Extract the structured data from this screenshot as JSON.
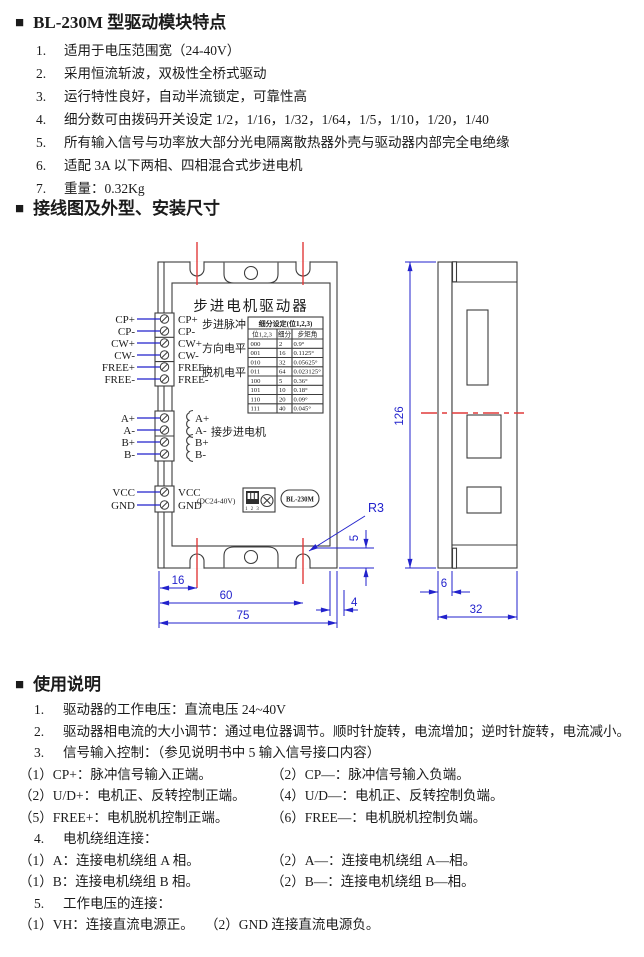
{
  "features": {
    "marker": "■",
    "title": "BL-230M 型驱动模块特点",
    "items": [
      {
        "num": "1.",
        "text": "适用于电压范围宽（24-40V）"
      },
      {
        "num": "2.",
        "text": "采用恒流斩波，双极性全桥式驱动"
      },
      {
        "num": "3.",
        "text": "运行特性良好，自动半流锁定，可靠性高"
      },
      {
        "num": "4.",
        "text": "细分数可由拨码开关设定 1/2，1/16，1/32，1/64，1/5，1/10，1/20，1/40"
      },
      {
        "num": "5.",
        "text": "所有输入信号与功率放大部分光电隔离散热器外壳与驱动器内部完全电绝缘"
      },
      {
        "num": "6.",
        "text": "适配 3A 以下两相、四相混合式步进电机"
      },
      {
        "num": "7.",
        "text": "重量：0.32Kg"
      }
    ]
  },
  "wiring_section": {
    "marker": "■",
    "title": "接线图及外型、安装尺寸"
  },
  "diagram": {
    "device_title": "步进电机驱动器",
    "signal_group_labels": [
      "步进脉冲",
      "方向电平",
      "脱机电平"
    ],
    "motor_group_label": "接步进电机",
    "power_note": "(DC24-40V)",
    "model_badge": "BL-230M",
    "dip_numbers": "1 2 3",
    "terminals": {
      "signal": [
        "CP+",
        "CP-",
        "CW+",
        "CW-",
        "FREE+",
        "FREE-"
      ],
      "motor": [
        "A+",
        "A-",
        "B+",
        "B-"
      ],
      "power": [
        "VCC",
        "GND"
      ]
    },
    "table": {
      "title": "细分设定(位1,2,3)",
      "headers": [
        "位1,2,3",
        "细分",
        "步矩角"
      ],
      "rows": [
        [
          "000",
          "2",
          "0.9°"
        ],
        [
          "001",
          "16",
          "0.1125°"
        ],
        [
          "010",
          "32",
          "0.05625°"
        ],
        [
          "011",
          "64",
          "0.023125°"
        ],
        [
          "100",
          "5",
          "0.36°"
        ],
        [
          "101",
          "10",
          "0.18°"
        ],
        [
          "110",
          "20",
          "0.09°"
        ],
        [
          "111",
          "40",
          "0.045°"
        ]
      ]
    },
    "dimensions": {
      "d16": "16",
      "d60": "60",
      "d75": "75",
      "d4": "4",
      "d5": "5",
      "r3": "R3",
      "d126": "126",
      "d6": "6",
      "d32": "32"
    },
    "colors": {
      "dimension_blue": "#2222cc",
      "centerline_red": "#e03a3a",
      "line_black": "#3c3c3c"
    }
  },
  "usage": {
    "marker": "■",
    "title": "使用说明",
    "lines": [
      {
        "type": "num",
        "num": "1.",
        "text": "驱动器的工作电压：直流电压 24~40V"
      },
      {
        "type": "num",
        "num": "2.",
        "text": "驱动器相电流的大小调节：通过电位器调节。顺时针旋转，电流增加；逆时针旋转，电流减小。"
      },
      {
        "type": "num",
        "num": "3.",
        "text": "信号输入控制：（参见说明书中 5 输入信号接口内容）"
      },
      {
        "type": "two",
        "left": "（1）CP+：脉冲信号输入正端。",
        "right": "（2）CP—：脉冲信号输入负端。"
      },
      {
        "type": "two",
        "left": "（2）U/D+：电机正、反转控制正端。",
        "right": "（4）U/D—：电机正、反转控制负端。"
      },
      {
        "type": "two",
        "left": "（5）FREE+：电机脱机控制正端。",
        "right": "（6）FREE—：电机脱机控制负端。"
      },
      {
        "type": "num",
        "num": "4.",
        "text": "电机绕组连接："
      },
      {
        "type": "two",
        "left": "（1）A：连接电机绕组 A 相。",
        "right": "（2）A—：连接电机绕组 A—相。"
      },
      {
        "type": "two",
        "left": "（1）B：连接电机绕组 B 相。",
        "right": "（2）B—：连接电机绕组 B—相。"
      },
      {
        "type": "num",
        "num": "5.",
        "text": "工作电压的连接："
      },
      {
        "type": "twoShort",
        "left": "（1）VH：连接直流电源正。",
        "right": "（2）GND 连接直流电源负。"
      }
    ]
  }
}
